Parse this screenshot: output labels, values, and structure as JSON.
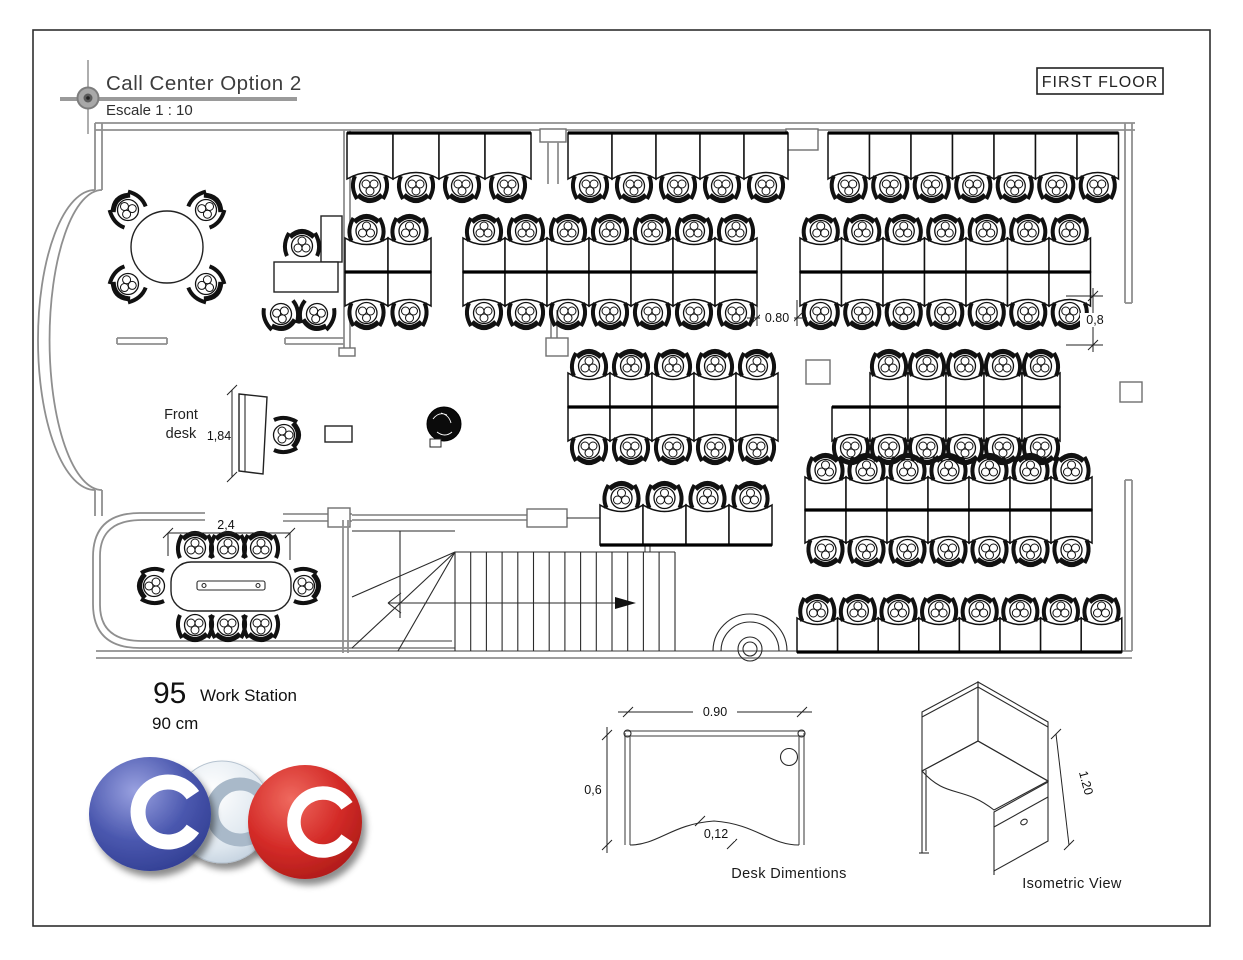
{
  "title_block": {
    "title": "Call Center Option 2",
    "scale": "Escale 1 : 10"
  },
  "floor_tag": {
    "label": "FIRST FLOOR"
  },
  "labels": {
    "front_desk_line1": "Front",
    "front_desk_line2": "desk"
  },
  "dimensions": {
    "front_desk_length": "1,84",
    "workstation_gap_horizontal": "0.80",
    "workstation_gap_vertical": "0,8",
    "conference_table_length": "2,4",
    "desk_width": "0.90",
    "desk_depth": "0,6",
    "desk_cut": "0,12",
    "workstation_height": "1.20"
  },
  "summary": {
    "workstation_count": "95",
    "workstation_label": "Work Station",
    "desk_size": "90 cm"
  },
  "captions": {
    "desk_diagram": "Desk Dimentions",
    "isometric_diagram": "Isometric View"
  },
  "logo": {
    "letters": "CCC",
    "colors": {
      "left": "#3f4da5",
      "middle": "#d7e1ea",
      "right": "#cf2a27"
    }
  },
  "plan": {
    "total_workstations": 95,
    "clusters": [
      {
        "name": "top-row-left",
        "x": 347,
        "y": 133,
        "cols": 4,
        "rows": 1,
        "w": 46,
        "h": 46,
        "chair": "s"
      },
      {
        "name": "top-row-middle",
        "x": 568,
        "y": 133,
        "cols": 5,
        "rows": 1,
        "w": 44,
        "h": 46,
        "chair": "s"
      },
      {
        "name": "top-row-right",
        "x": 828,
        "y": 133,
        "cols": 7,
        "rows": 1,
        "w": 41.5,
        "h": 46,
        "chair": "s"
      },
      {
        "name": "island-a",
        "x": 345,
        "y": 238,
        "cols": 2,
        "rows": 2,
        "w": 43,
        "h": 34
      },
      {
        "name": "island-b",
        "x": 463,
        "y": 238,
        "cols": 7,
        "rows": 2,
        "w": 42,
        "h": 34
      },
      {
        "name": "island-c",
        "x": 800,
        "y": 238,
        "cols": 7,
        "rows": 2,
        "w": 41.5,
        "h": 34
      },
      {
        "name": "island-d",
        "x": 568,
        "y": 373,
        "cols": 5,
        "rows": 2,
        "w": 42,
        "h": 34
      },
      {
        "name": "island-e",
        "x": 832,
        "y": 373,
        "cols": 6,
        "rows": 2,
        "w": 38,
        "h": 34,
        "skip": [
          [
            0,
            0
          ]
        ]
      },
      {
        "name": "row-above-stairs",
        "x": 600,
        "y": 505,
        "cols": 4,
        "rows": 1,
        "w": 43,
        "h": 40,
        "chair": "n"
      },
      {
        "name": "island-f",
        "x": 805,
        "y": 477,
        "cols": 7,
        "rows": 2,
        "w": 41,
        "h": 33
      },
      {
        "name": "bottom-row",
        "x": 797,
        "y": 618,
        "cols": 8,
        "rows": 1,
        "w": 40.6,
        "h": 34,
        "chair": "n"
      }
    ]
  }
}
